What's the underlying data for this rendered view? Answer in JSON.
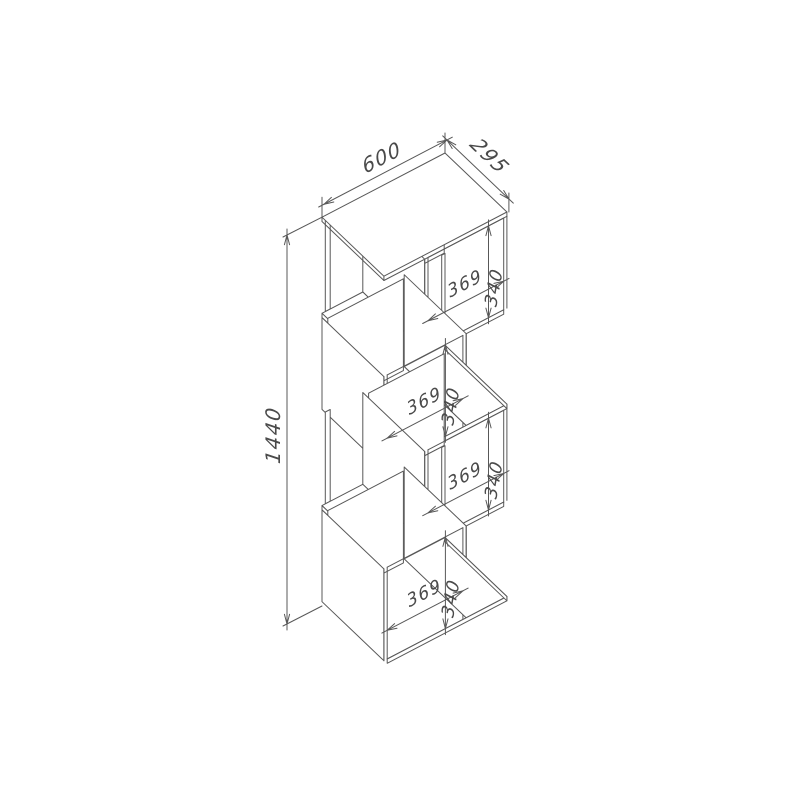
{
  "drawing": {
    "type": "isometric-furniture-dimension-diagram",
    "subject": "four-tier zigzag shelving unit",
    "background_color": "#ffffff",
    "line_color": "#585858",
    "text_color": "#4a4a4a",
    "dimensions": {
      "width_mm": "600",
      "depth_mm": "295",
      "height_mm": "1440",
      "compartment_width_mm": "369",
      "compartment_height_mm": "340"
    },
    "tiers": [
      {
        "side": "right",
        "compartment_width": "369",
        "compartment_height": "340"
      },
      {
        "side": "left",
        "compartment_width": "369",
        "compartment_height": "340"
      },
      {
        "side": "right",
        "compartment_width": "369",
        "compartment_height": "340"
      },
      {
        "side": "left",
        "compartment_width": "369",
        "compartment_height": "340"
      }
    ]
  }
}
